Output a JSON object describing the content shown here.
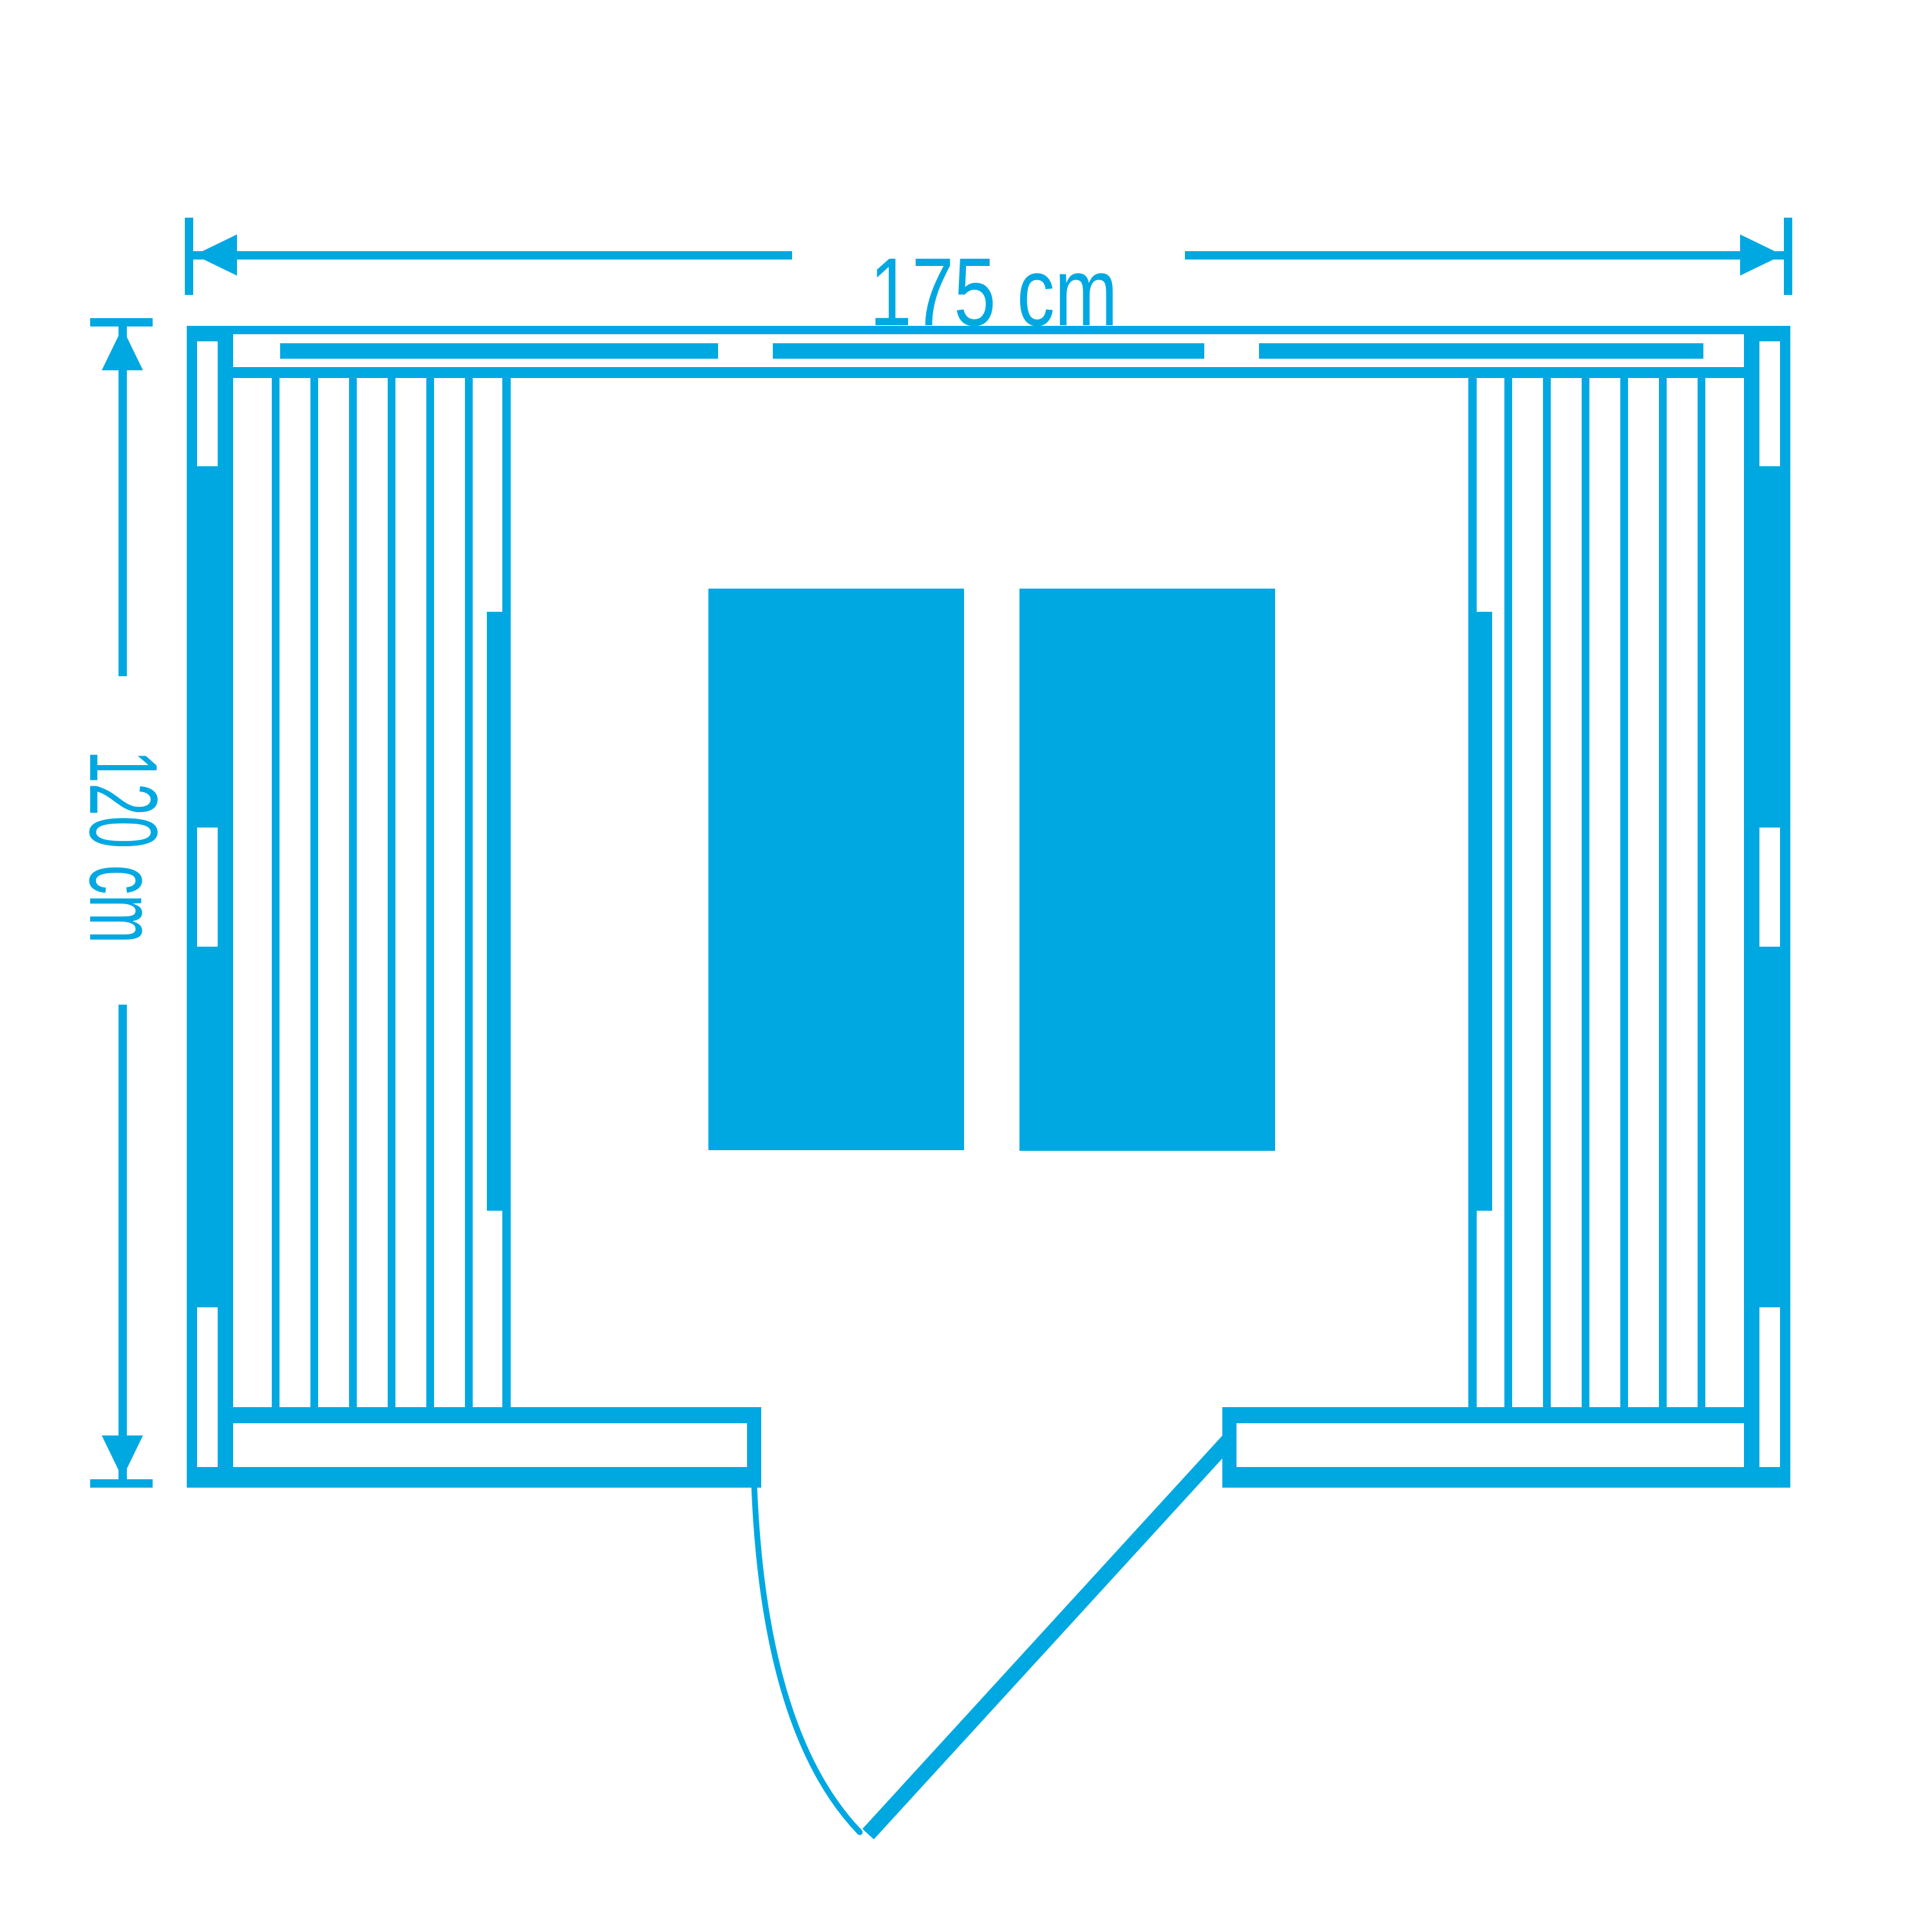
{
  "colors": {
    "accent": "#00A8E2",
    "background": "#ffffff"
  },
  "dimensions": {
    "width": {
      "label": "175 cm"
    },
    "depth": {
      "label": "120 cm"
    }
  }
}
